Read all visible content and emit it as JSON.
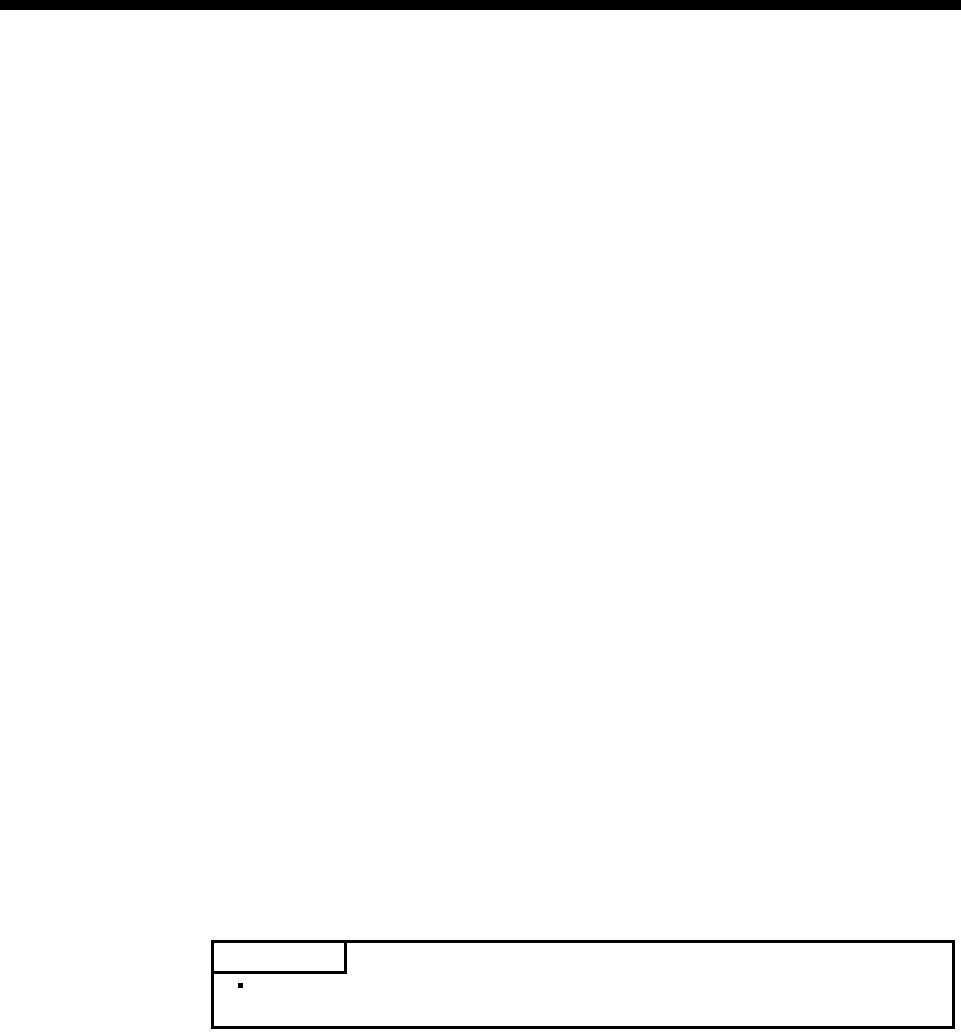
{
  "page": {
    "background_color": "#ffffff",
    "ink_color": "#000000"
  },
  "top_bar": {
    "color": "#000000"
  },
  "note_box": {
    "label_text": "",
    "body_text": "",
    "border_color": "#000000"
  },
  "icons": {
    "bullet-square-icon": "▪"
  }
}
